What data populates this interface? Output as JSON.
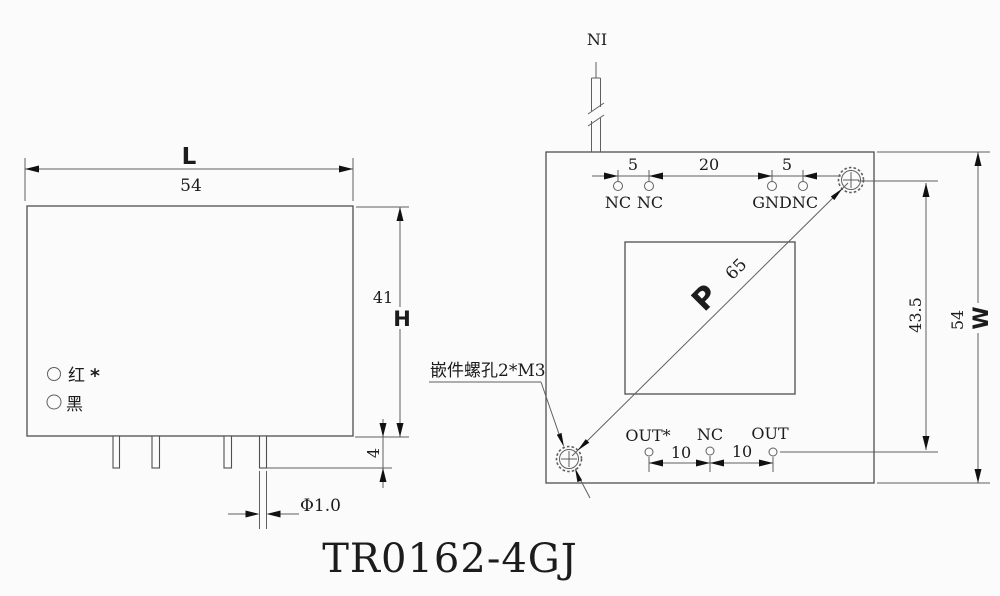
{
  "title": "TR0162-4GJ",
  "colors": {
    "line": "#5f5f5f",
    "text": "#1c1c1c",
    "background": "#fbfbfb"
  },
  "side_view": {
    "dim_length_letter": "L",
    "dim_length": "54",
    "dim_height": "41",
    "dim_height_letter": "H",
    "dim_pin_length": "4",
    "dim_pin_diameter": "Φ1.0",
    "lead_red": "红",
    "lead_red_mark": "*",
    "lead_black": "黑"
  },
  "top_view": {
    "tag": "NI",
    "dims_top": [
      "5",
      "20",
      "5"
    ],
    "pins_top": [
      "NC",
      "NC",
      "GND",
      "NC"
    ],
    "pins_bottom": [
      "OUT*",
      "NC",
      "OUT"
    ],
    "dims_bottom": [
      "10",
      "10"
    ],
    "diag_letter": "P",
    "diag_value": "65",
    "dim_inner_width": "43.5",
    "dim_width": "54",
    "dim_width_letter": "W",
    "screw_note": "嵌件螺孔2*M3"
  }
}
